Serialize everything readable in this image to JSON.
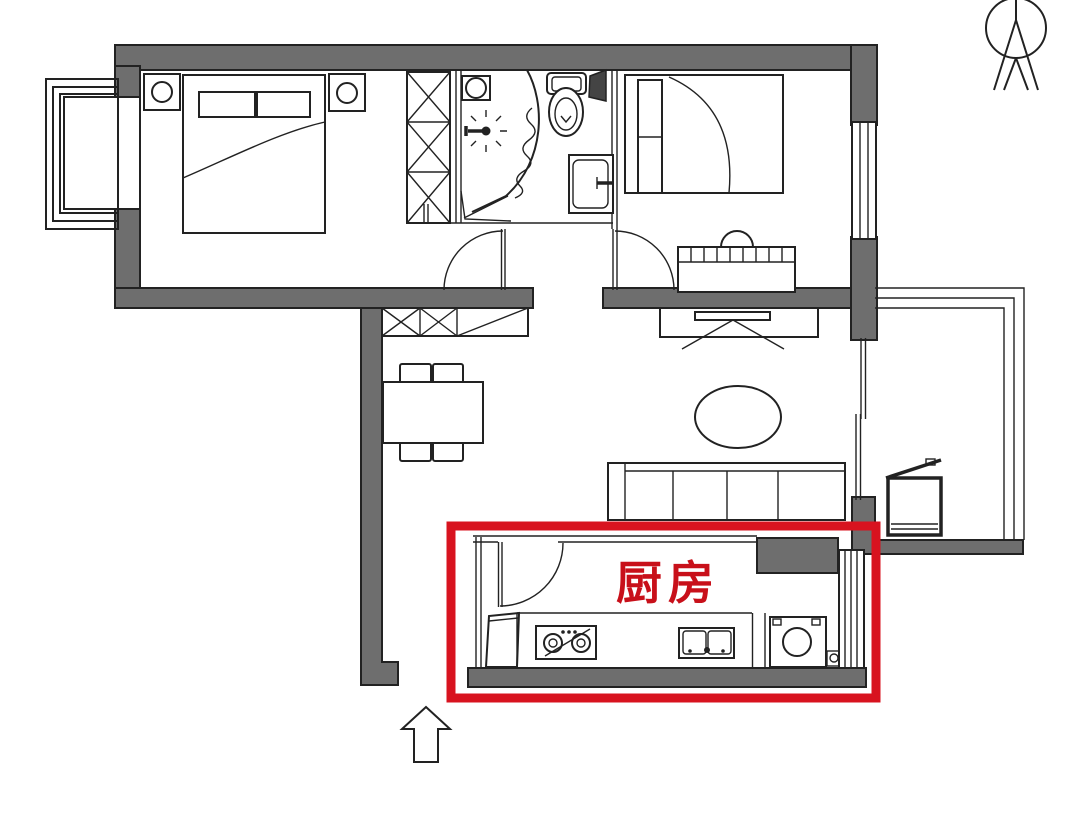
{
  "labels": {
    "kitchen": "厨房"
  },
  "highlight": {
    "shape": "rectangle",
    "label": "厨房",
    "color": "#d8131f"
  },
  "icons": {
    "north": "north-compass-icon",
    "entrance": "entrance-arrow-icon",
    "shower": "shower-head-icon",
    "toilet": "toilet-icon",
    "sink": "sink-icon",
    "stove": "gas-stove-icon",
    "washer": "washing-machine-icon"
  },
  "colors": {
    "bg": "#ffffff",
    "wall-fill": "#6e6e6e",
    "line": "#222222",
    "shaft-fill": "#444444",
    "red-box": "#d8131f",
    "red-text": "#c8101a"
  }
}
